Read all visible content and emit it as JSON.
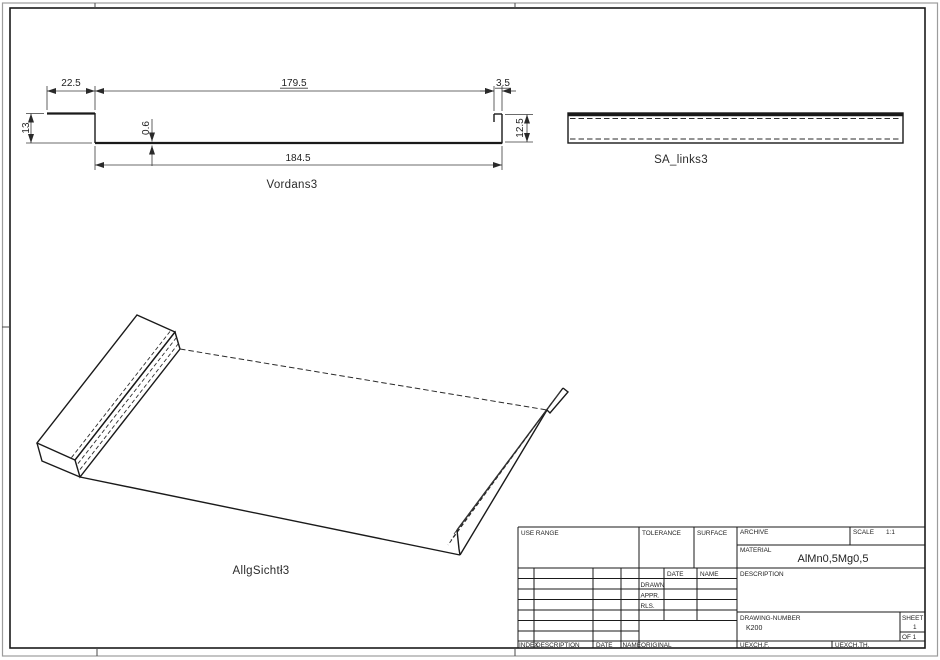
{
  "front_view": {
    "label": "Vordans3",
    "dim_top_left": "22.5",
    "dim_top_mid": "179.5",
    "dim_top_right": "3.5",
    "dim_left": "13",
    "dim_thickness": "0.6",
    "dim_right": "12.5",
    "dim_bottom": "184.5"
  },
  "side_view": {
    "label": "SA_links3"
  },
  "iso_view": {
    "label": "AllgSichtł3"
  },
  "title_block": {
    "use_range_label": "USE RANGE",
    "tolerance_label": "TOLERANCE",
    "surface_label": "SURFACE",
    "archive_label": "ARCHIVE",
    "scale_label": "SCALE",
    "scale_value": "1:1",
    "material_label": "MATERIAL",
    "material_value": "AlMn0,5Mg0,5",
    "date_label": "DATE",
    "name_label": "NAME",
    "drawn_label": "DRAWN",
    "appr_label": "APPR.",
    "rls_label": "RLS.",
    "description_label": "DESCRIPTION",
    "drawing_number_label": "DRAWING-NUMBER",
    "drawing_number_value": "K200",
    "sheet_label": "SHEET",
    "sheet_value": "1",
    "of_label": "OF 1",
    "index_label": "INDEX",
    "rev_description_label": "DESCRIPTION",
    "rev_date_label": "DATE",
    "rev_name_label": "NAME",
    "original_label": "ORIGINAL",
    "uexchf_label": "UEXCH.F.",
    "uexchth_label": "UEXCH.TH."
  }
}
